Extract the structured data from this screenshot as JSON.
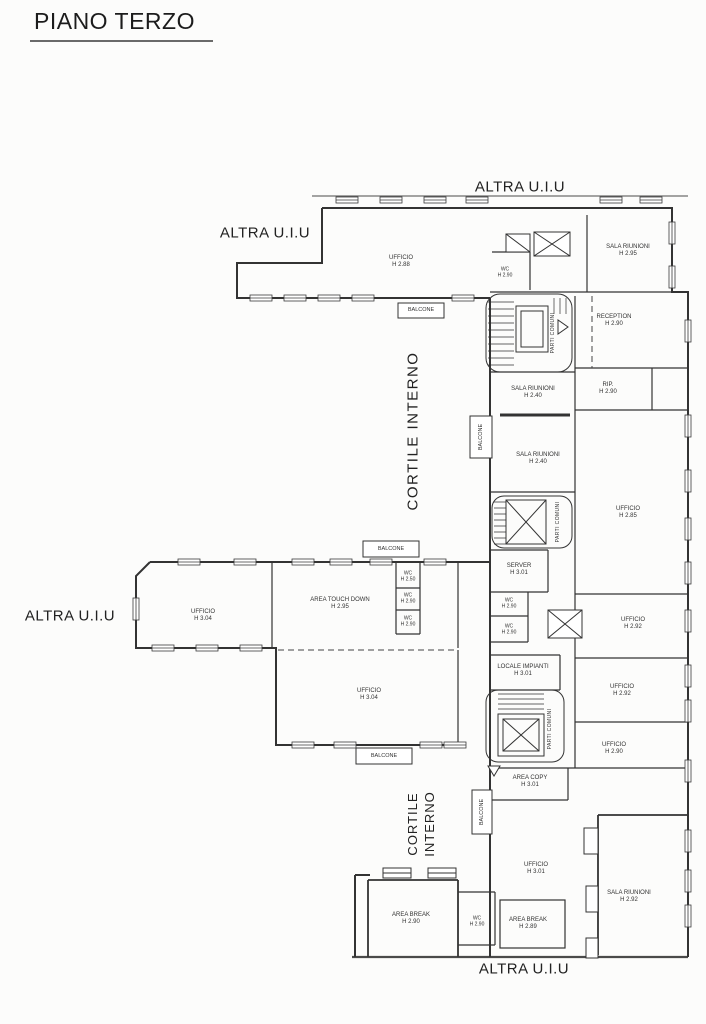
{
  "title": "PIANO TERZO",
  "plan": {
    "external_labels": [
      "ALTRA U.I.U",
      "ALTRA U.I.U",
      "ALTRA U.I.U",
      "ALTRA U.I.U"
    ],
    "courtyard_upper": "CORTILE INTERNO",
    "courtyard_lower": {
      "line1": "CORTILE",
      "line2": "INTERNO"
    },
    "balconies": [
      "BALCONE",
      "BALCONE",
      "BALCONE",
      "BALCONE",
      "BALCONE"
    ],
    "parti_comuni": [
      "PARTI COMUNI",
      "PARTI COMUNI",
      "PARTI COMUNI"
    ],
    "rooms": [
      {
        "name": "UFFICIO",
        "height": "H 2.88"
      },
      {
        "name": "SALA RIUNIONI",
        "height": "H 2.95"
      },
      {
        "name": "WC",
        "height": "H 2.90"
      },
      {
        "name": "RECEPTION",
        "height": "H 2.90"
      },
      {
        "name": "SALA RIUNIONI",
        "height": "H 2.40"
      },
      {
        "name": "RIP.",
        "height": "H 2.90"
      },
      {
        "name": "SALA RIUNIONI",
        "height": "H 2.40"
      },
      {
        "name": "UFFICIO",
        "height": "H 2.85"
      },
      {
        "name": "SERVER",
        "height": "H 3.01"
      },
      {
        "name": "WC",
        "height": "H 2.90"
      },
      {
        "name": "WC",
        "height": "H 2.90"
      },
      {
        "name": "UFFICIO",
        "height": "H 2.92"
      },
      {
        "name": "UFFICIO",
        "height": "H 3.04"
      },
      {
        "name": "AREA TOUCH DOWN",
        "height": "H 2.95"
      },
      {
        "name": "WC",
        "height": "H 2.50"
      },
      {
        "name": "WC",
        "height": "H 2.90"
      },
      {
        "name": "WC",
        "height": "H 2.90"
      },
      {
        "name": "UFFICIO",
        "height": "H 3.04"
      },
      {
        "name": "LOCALE IMPIANTI",
        "height": "H 3.01"
      },
      {
        "name": "UFFICIO",
        "height": "H 2.92"
      },
      {
        "name": "UFFICIO",
        "height": "H 2.90"
      },
      {
        "name": "AREA COPY",
        "height": "H 3.01"
      },
      {
        "name": "UFFICIO",
        "height": "H 3.01"
      },
      {
        "name": "SALA RIUNIONI",
        "height": "H 2.92"
      },
      {
        "name": "AREA BREAK",
        "height": "H 2.90"
      },
      {
        "name": "WC",
        "height": "H 2.90"
      },
      {
        "name": "AREA BREAK",
        "height": "H 2.89"
      }
    ]
  }
}
